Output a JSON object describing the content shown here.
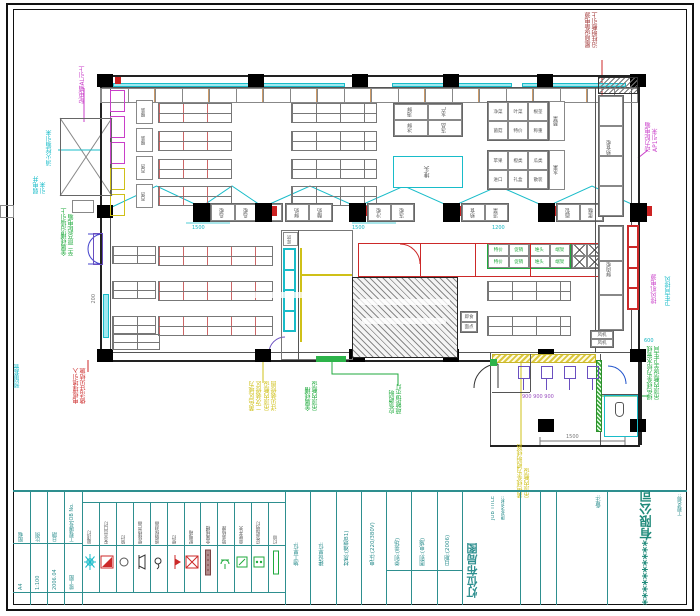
{
  "title_block": {
    "left_cols": [
      {
        "top": "图幅",
        "bottom": "A4"
      },
      {
        "top": "比例",
        "bottom": "1:100"
      },
      {
        "top": "日期",
        "bottom": "2006.04"
      },
      {
        "top": "工程编号JOB No.",
        "bottom": "竣工图"
      }
    ],
    "middle_fields": [
      "施工单位:",
      "建设单位:",
      "材质:(难燃B1)",
      "电压:(220/380V)",
      "类别:(卖场)",
      "图别:(电施)",
      "日期:(2006)"
    ],
    "job_title_label": "图纸名称:",
    "job_title_en": "JOB TITLE",
    "drawing_title": "灯位布局图",
    "remark_label": "备注:",
    "project_label": "工程名称:",
    "company": "**********有限公司"
  },
  "legend": {
    "items": [
      {
        "label": "吸顶灯",
        "symbol": "ceiling-light"
      },
      {
        "label": "安全出口灯",
        "symbol": "exit-light"
      },
      {
        "label": "筒灯",
        "symbol": "downlight"
      },
      {
        "label": "壁挂扬声器",
        "symbol": "speaker"
      },
      {
        "label": "感烟探测器",
        "symbol": "smoke-detector"
      },
      {
        "label": "壁灯",
        "symbol": "wall-light"
      },
      {
        "label": "配电箱",
        "symbol": "dist-box"
      },
      {
        "label": "金属线槽",
        "symbol": "trunking"
      },
      {
        "label": "暗装插座",
        "symbol": "socket"
      },
      {
        "label": "单联开关",
        "symbol": "switch"
      },
      {
        "label": "应急照明灯",
        "symbol": "emergency-light"
      },
      {
        "label": "灯带",
        "symbol": "light-strip"
      }
    ]
  },
  "annotations": {
    "a1": {
      "lines": [
        "配电箱AL引上"
      ]
    },
    "a2": {
      "lines": [
        "消火栓箱引来"
      ]
    },
    "a3": {
      "lines": [
        "弱电井",
        "引来"
      ]
    },
    "a4": {
      "lines": [
        "金属线槽沿墙引上",
        "至二层总配电箱"
      ]
    },
    "a5": {
      "lines": [
        "电缆埋地引入",
        "做法详见结施"
      ]
    },
    "a6": {
      "lines": [
        "预留套管"
      ]
    },
    "a7": {
      "lines": [
        "黄色区域为",
        "二次装修区",
        "吊顶内敷设",
        "详见装修图"
      ]
    },
    "a8": {
      "lines": [
        "金属线槽",
        "吊顶内敷设"
      ]
    },
    "a9": {
      "lines": [
        "应急照明",
        "疏散指示灯"
      ]
    },
    "a10": {
      "lines": [
        "黄色线条为照明线路",
        "吊顶内敷设"
      ]
    },
    "a11": {
      "lines": [
        "绿色线条为给水管线",
        "吊顶内敷设至卫生间"
      ]
    },
    "a12": {
      "lines": [
        "屋面设备电源",
        "沿柱明敷引上"
      ]
    },
    "a13": {
      "lines": [
        "动力配电箱",
        "AP1引来"
      ]
    },
    "a14": {
      "lines": [
        "排风机电源"
      ]
    },
    "a15": {
      "lines": [
        "卫生间排风"
      ]
    }
  },
  "plan": {
    "freezer_groups": [
      [
        "岛柜",
        "岛柜",
        "岛柜"
      ],
      [
        "鲜奶",
        "酸奶"
      ],
      [
        "冷柜",
        "冻柜"
      ],
      [
        "熟食",
        "凉菜"
      ],
      [
        "面包",
        "蛋糕"
      ]
    ],
    "tables_r1": [
      [
        "海鲜",
        "水产"
      ],
      [
        "冰鲜",
        "冻品"
      ]
    ],
    "cyan_box_label": "堆头",
    "grid1_side": "蔬菜",
    "grid1": [
      [
        "净菜",
        "叶菜",
        "根茎"
      ],
      [
        "菌菇",
        "特价",
        "称重"
      ]
    ],
    "grid2_side": "水果",
    "grid2": [
      [
        "苹果",
        "橙类",
        "瓜类"
      ],
      [
        "进口",
        "礼盒",
        "散装"
      ]
    ],
    "green_grid": [
      [
        "特价",
        "促销",
        "堆头",
        "端架"
      ],
      [
        "特价",
        "促销",
        "堆头",
        "端架"
      ]
    ],
    "left_rack_labels": [
      "服装",
      "服装",
      "百货",
      "百货"
    ],
    "counter_top": "熟食柜",
    "counter_bottom": "鲜肉柜",
    "fan_cells": [
      "风机",
      "风机"
    ],
    "small_boxes": [
      "即食",
      "面点"
    ],
    "room_label": "库房",
    "dims": {
      "d1": "1500",
      "d2": "1500",
      "d3": "1200",
      "d4": "1500",
      "d5": "600",
      "d6": "200",
      "d7": "900  900  900"
    }
  },
  "colors": {
    "cyan": "#00c2cc",
    "magenta": "#c93fc9",
    "green": "#1faa3c",
    "red": "#cc2929",
    "dark_red": "#a03535",
    "yellow": "#cfc018",
    "purple": "#6a4fc0",
    "teal": "#2e8f8f",
    "maroon": "#8a4b4b"
  }
}
